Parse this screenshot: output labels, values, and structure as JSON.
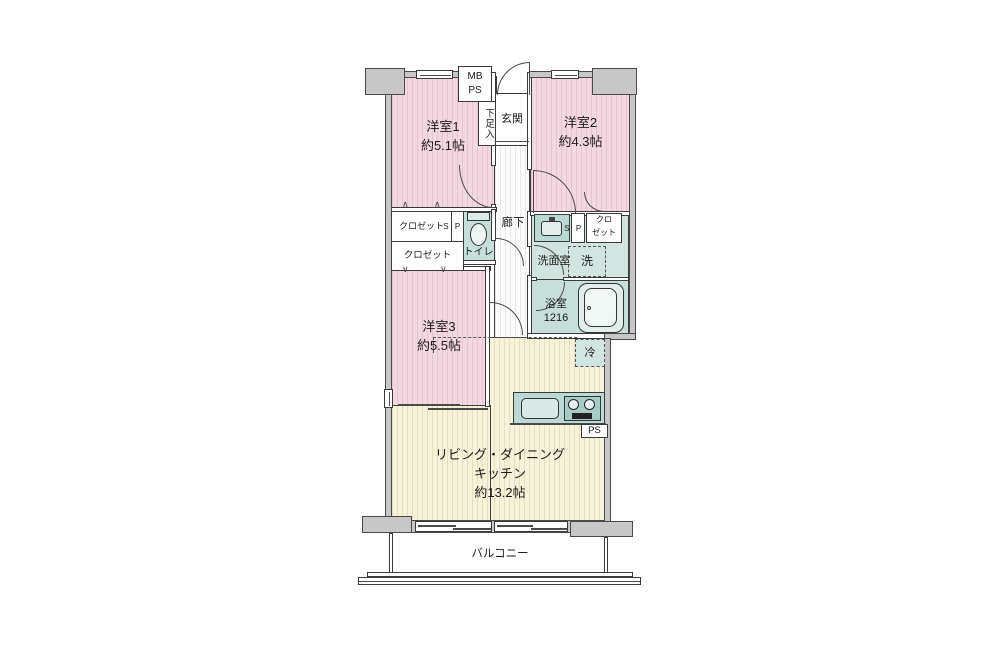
{
  "floorplan": {
    "labels": {
      "mb_ps": "MB\nPS",
      "shoe_box": "下足入",
      "entrance": "玄関",
      "hallway": "廊下",
      "room1": "洋室1\n約5.1帖",
      "room2": "洋室2\n約4.3帖",
      "room3": "洋室3\n約5.5帖",
      "closet1": "クロゼット",
      "closet2": "クロゼット",
      "closet_small": "クロ\nゼット",
      "ps_top": "P\nS",
      "ps_wash": "P\nS",
      "ps_kitchen": "PS",
      "toilet": "トイレ",
      "washroom": "洗面室",
      "washer": "洗",
      "bathroom": "浴室\n1216",
      "fridge": "冷",
      "ldk": "リビング・ダイニング\nキッチン\n約13.2帖",
      "balcony": "バルコニー"
    },
    "colors": {
      "room_pink": "#f3d8e1",
      "ldk_cream": "#f7f2da",
      "wet_area_teal": "#c8dedb",
      "wall_gray": "#c7c7c7",
      "outline": "#4a4a4a"
    }
  }
}
